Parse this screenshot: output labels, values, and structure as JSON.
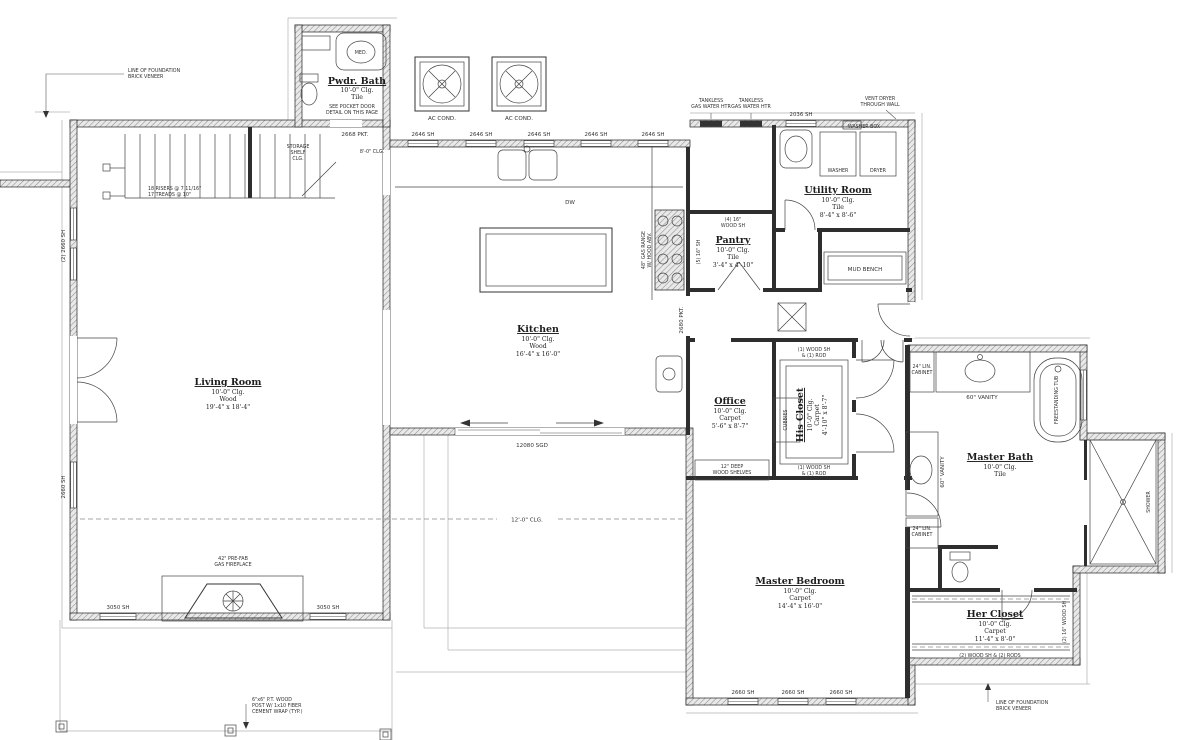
{
  "rooms": {
    "powder_bath": {
      "name": "Pwdr. Bath",
      "ceiling": "10'-0\" Clg.",
      "floor": "Tile"
    },
    "living_room": {
      "name": "Living Room",
      "ceiling": "10'-0\" Clg.",
      "floor": "Wood",
      "dims": "19'-4\" x 18'-4\""
    },
    "kitchen": {
      "name": "Kitchen",
      "ceiling": "10'-0\" Clg.",
      "floor": "Wood",
      "dims": "16'-4\" x 16'-0\""
    },
    "utility": {
      "name": "Utility Room",
      "ceiling": "10'-0\" Clg.",
      "floor": "Tile",
      "dims": "8'-4\" x 8'-6\""
    },
    "pantry": {
      "name": "Pantry",
      "ceiling": "10'-0\" Clg.",
      "floor": "Tile",
      "dims": "3'-4\" x 4'-10\""
    },
    "office": {
      "name": "Office",
      "ceiling": "10'-0\" Clg.",
      "floor": "Carpet",
      "dims": "5'-6\" x 8'-7\""
    },
    "his_closet": {
      "name": "His Closet",
      "ceiling": "10'-0\" Clg.",
      "floor": "Carpet",
      "dims": "4'-10\" x 8'-7\""
    },
    "master_bedroom": {
      "name": "Master Bedroom",
      "ceiling": "10'-0\" Clg.",
      "floor": "Carpet",
      "dims": "14'-4\" x 16'-0\""
    },
    "master_bath": {
      "name": "Master Bath",
      "ceiling": "10'-0\" Clg.",
      "floor": "Tile"
    },
    "her_closet": {
      "name": "Her Closet",
      "ceiling": "10'-0\" Clg.",
      "floor": "Carpet",
      "dims": "11'-4\" x 8'-0\""
    }
  },
  "windows": {
    "kitchen": "2646 SH",
    "utility": "2036 SH",
    "left_pair": "(2) 2660 SH",
    "left_single": "2660 SH",
    "living_bottom": "3050 SH",
    "bedroom": "2660 SH"
  },
  "doors": {
    "powder_pocket": "2668 PKT.",
    "office_pocket": "2680 PKT.",
    "slider": "12080 SGD"
  },
  "annotations": {
    "foundation": [
      "LINE OF FOUNDATION",
      "BRICK VENEER"
    ],
    "stairs": [
      "18 RISERS @ 7 11/16\"",
      "17 TREADS @ 10\""
    ],
    "storage": [
      "STORAGE",
      "SHELF",
      "CLG."
    ],
    "under_stair": "8'-0\" CLG.",
    "pocket_detail": [
      "SEE POCKET DOOR",
      "DETAIL ON THIS PAGE"
    ],
    "ac": "AC COND.",
    "tankless": [
      "TANKLESS",
      "GAS WATER HTR"
    ],
    "vent": [
      "VENT DRYER",
      "THROUGH WALL"
    ],
    "washer_box": "WASHER BOX",
    "washer": "WASHER",
    "dryer": "DRYER",
    "mud_bench": "MUD BENCH",
    "pantry_shelves": [
      "(4) 16\"",
      "WOOD SH"
    ],
    "pantry_side": "(5) 16\" SH",
    "range": [
      "48\" GAS RANGE",
      "W/ HOOD ABV."
    ],
    "dw": "DW",
    "clg12": "12'-0\" CLG.",
    "office_shelves": [
      "12\" DEEP",
      "WOOD SHELVES"
    ],
    "rod1": [
      "(1) WOOD SH",
      "& (1) ROD"
    ],
    "cubbies": "CUBBIES",
    "lin_cabinet": [
      "24\" LIN.",
      "CABINET"
    ],
    "vanity": "60\" VANITY",
    "tub": "FREESTANDING TUB",
    "shower": "SHOWER",
    "her_rods": "(2) WOOD SH & (2) RODS",
    "her_side": "(2) 16\" WOOD SH",
    "fireplace": [
      "42\" PRE-FAB",
      "GAS FIREPLACE"
    ],
    "post": [
      "6\"x6\" P.T. WOOD",
      "POST W/ 1x10 FIBER",
      "CEMENT WRAP (TYP.)"
    ],
    "med": "MED."
  }
}
